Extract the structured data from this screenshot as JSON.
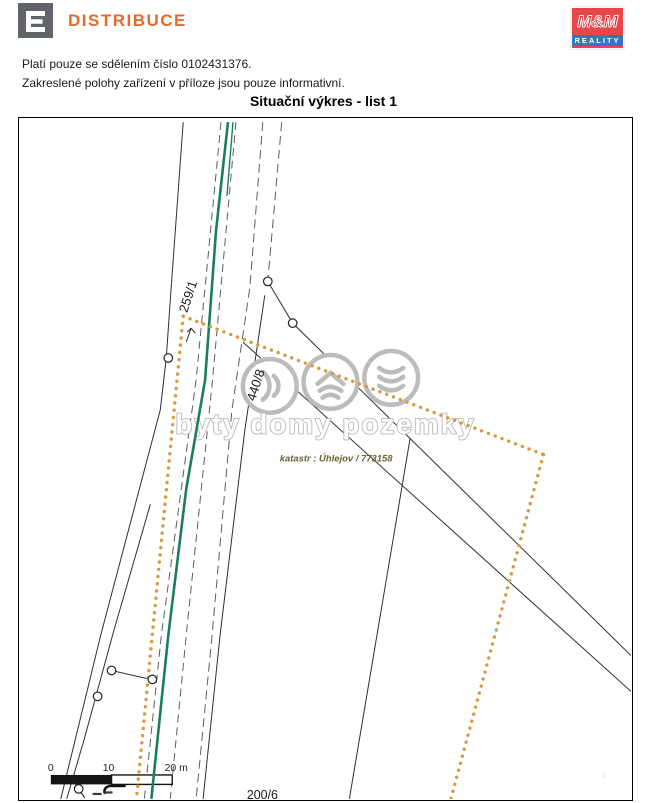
{
  "header": {
    "cez_brand": "DISTRIBUCE",
    "mm_top": "M&M",
    "mm_bottom": "REALITY"
  },
  "notices": {
    "line1": "Platí pouze se sdělením číslo 0102431376.",
    "line2": "Zakreslené polohy zařízení v příloze jsou pouze informativní."
  },
  "title": "Situační výkres - list 1",
  "map": {
    "parcels": {
      "p259": "259/1",
      "p440": "440/8",
      "p200": "200/6"
    },
    "katastr_label": "katastr : Úhlejov / 773158",
    "watermark_text": "byty domy pozemky",
    "micro_mark": "©",
    "scale": {
      "zero": "0",
      "ten": "10",
      "twenty": "20 m"
    },
    "colors": {
      "power_line_green": "#1b7d5e",
      "boundary_orange": "#d9993f",
      "parcel_line_black": "#2e2e2e",
      "watermark_gray": "#b8b8b8",
      "cez_orange": "#e8682c",
      "mm_red": "#e8474a",
      "mm_blue": "#2e79c2"
    }
  }
}
